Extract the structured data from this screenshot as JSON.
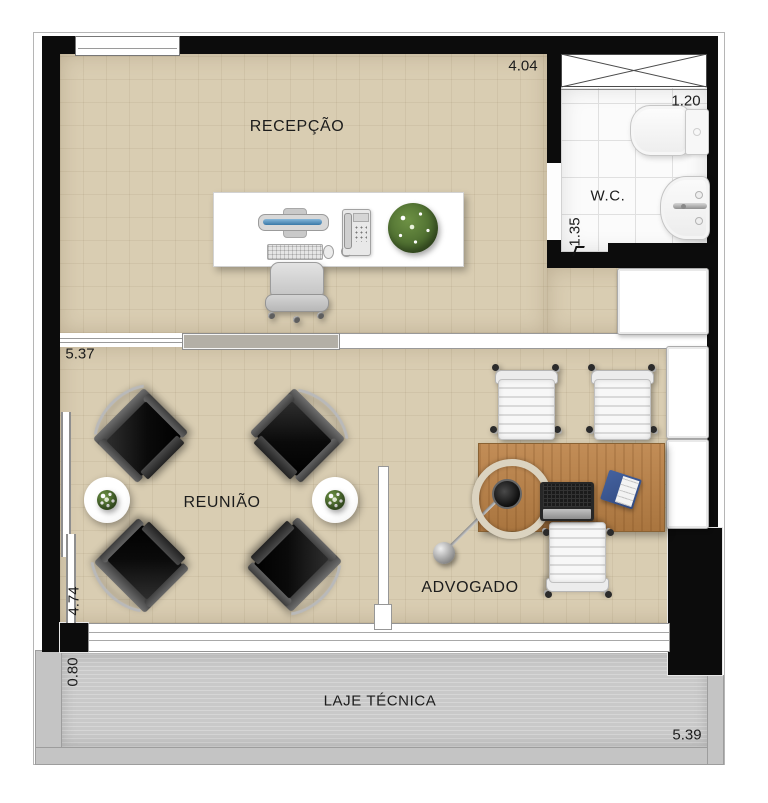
{
  "rooms": {
    "recepcao": {
      "label": "RECEPÇÃO"
    },
    "wc": {
      "label": "W.C."
    },
    "reuniao": {
      "label": "REUNIÃO"
    },
    "advogado": {
      "label": "ADVOGADO"
    },
    "laje_tecnica": {
      "label": "LAJE TÉCNICA"
    }
  },
  "dimensions": {
    "recepcao_width": "4.04",
    "wc_width": "1.20",
    "wc_depth": "1.35",
    "reuniao_width": "5.37",
    "reuniao_depth": "4.74",
    "laje_depth": "0.80",
    "laje_width": "5.39"
  },
  "colors": {
    "floor": "#d9cdb2",
    "wall": "#0c0c0c",
    "tile": "#fbfbfb",
    "laje": "#c9c9c9",
    "wood": "#b5834e",
    "monitor_blue": "#4a7fae",
    "notebook_blue": "#3d5fa8",
    "plant_green": "#55743a"
  }
}
